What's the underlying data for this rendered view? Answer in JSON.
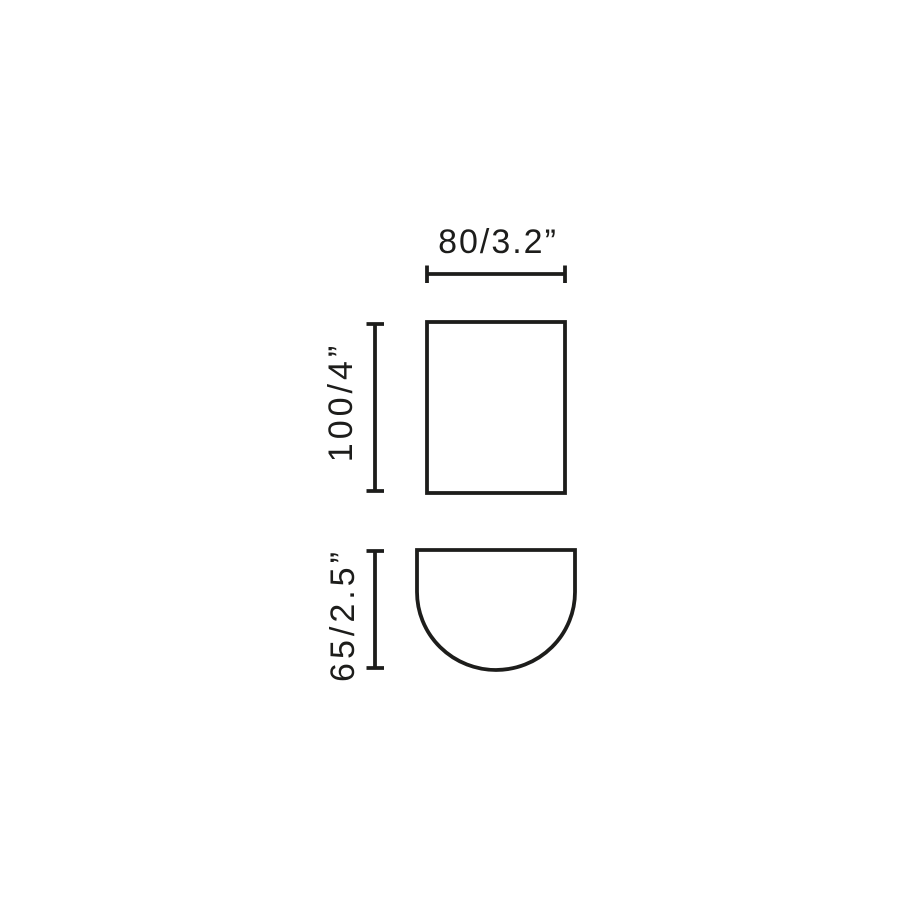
{
  "diagram": {
    "kind": "product-dimension-drawing",
    "background_color": "#ffffff",
    "line_color": "#1d1d1b",
    "views": [
      {
        "id": "front-view",
        "shape": "rectangle",
        "description": "front elevation outline"
      },
      {
        "id": "profile-view",
        "shape": "half-round",
        "description": "flat-top outline with semicircular bottom"
      }
    ],
    "dimensions": {
      "width": {
        "label": "80/3.2”",
        "millimeters": 80,
        "inches": 3.2,
        "orientation": "horizontal",
        "applies_to": "front-view"
      },
      "height": {
        "label": "100/4”",
        "millimeters": 100,
        "inches": 4,
        "orientation": "vertical",
        "applies_to": "front-view"
      },
      "depth": {
        "label": "65/2.5”",
        "millimeters": 65,
        "inches": 2.5,
        "orientation": "vertical",
        "applies_to": "profile-view"
      }
    }
  }
}
